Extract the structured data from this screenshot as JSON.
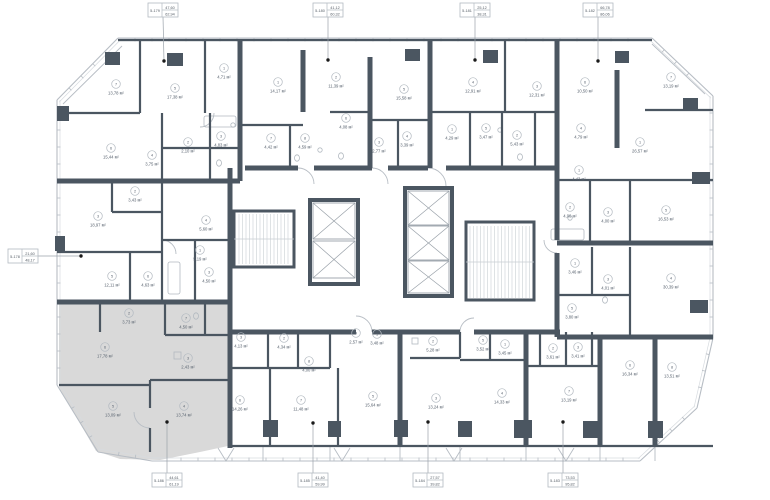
{
  "meta": {
    "area_unit": "м²",
    "selected_unit": "5-186",
    "colors": {
      "wall": "#4b5661",
      "highlight": "#d9d9d9",
      "line": "#b7bdc4",
      "text": "#5a6470",
      "dot": "#1a1a1a"
    }
  },
  "callouts": [
    {
      "id": "5-179",
      "v1": "47,60",
      "v2": "62,94",
      "bx": 148,
      "by": 3,
      "dx": 164,
      "dy": 61,
      "side": "top"
    },
    {
      "id": "5-180",
      "v1": "41,12",
      "v2": "60,32",
      "bx": 313,
      "by": 3,
      "dx": 328,
      "dy": 60,
      "side": "top"
    },
    {
      "id": "5-181",
      "v1": "25,12",
      "v2": "38,31",
      "bx": 460,
      "by": 3,
      "dx": 475,
      "dy": 60,
      "side": "top"
    },
    {
      "id": "5-182",
      "v1": "66,78",
      "v2": "86,06",
      "bx": 583,
      "by": 3,
      "dx": 598,
      "dy": 61,
      "side": "top"
    },
    {
      "id": "5-178",
      "v1": "21,60",
      "v2": "48,17",
      "bx": 8,
      "by": 249,
      "dx": 81,
      "dy": 256,
      "side": "left"
    },
    {
      "id": "5-186",
      "v1": "44,61",
      "v2": "61,19",
      "bx": 152,
      "by": 473,
      "dx": 167,
      "dy": 422,
      "side": "bottom"
    },
    {
      "id": "5-185",
      "v1": "41,40",
      "v2": "59,99",
      "bx": 298,
      "by": 473,
      "dx": 313,
      "dy": 423,
      "side": "bottom"
    },
    {
      "id": "5-184",
      "v1": "27,57",
      "v2": "39,82",
      "bx": 413,
      "by": 473,
      "dx": 428,
      "dy": 422,
      "side": "bottom"
    },
    {
      "id": "5-183",
      "v1": "73,53",
      "v2": "95,82",
      "bx": 548,
      "by": 473,
      "dx": 563,
      "dy": 422,
      "side": "bottom"
    }
  ],
  "rooms": [
    {
      "n": "7",
      "a": "13,78",
      "x": 116,
      "y": 84
    },
    {
      "n": "5",
      "a": "17,38",
      "x": 175,
      "y": 88
    },
    {
      "n": "1",
      "a": "4,71",
      "x": 224,
      "y": 68
    },
    {
      "n": "6",
      "a": "15,44",
      "x": 111,
      "y": 148
    },
    {
      "n": "2",
      "a": "2,10",
      "x": 188,
      "y": 142
    },
    {
      "n": "4",
      "a": "3,75",
      "x": 152,
      "y": 155
    },
    {
      "n": "3",
      "a": "4,83",
      "x": 221,
      "y": 136
    },
    {
      "n": "1",
      "a": "14,17",
      "x": 278,
      "y": 82
    },
    {
      "n": "2",
      "a": "11,39",
      "x": 336,
      "y": 77
    },
    {
      "n": "5",
      "a": "15,58",
      "x": 404,
      "y": 89
    },
    {
      "n": "6",
      "a": "4,08",
      "x": 346,
      "y": 118
    },
    {
      "n": "7",
      "a": "4,42",
      "x": 271,
      "y": 138
    },
    {
      "n": "8",
      "a": "4,59",
      "x": 305,
      "y": 138
    },
    {
      "n": "3",
      "a": "2,77",
      "x": 379,
      "y": 142
    },
    {
      "n": "4",
      "a": "3,39",
      "x": 407,
      "y": 136
    },
    {
      "n": "4",
      "a": "12,91",
      "x": 473,
      "y": 82
    },
    {
      "n": "3",
      "a": "12,31",
      "x": 537,
      "y": 86
    },
    {
      "n": "6",
      "a": "10,50",
      "x": 585,
      "y": 82
    },
    {
      "n": "1",
      "a": "4,29",
      "x": 452,
      "y": 129
    },
    {
      "n": "5",
      "a": "3,47",
      "x": 486,
      "y": 128
    },
    {
      "n": "2",
      "a": "5,43",
      "x": 517,
      "y": 135
    },
    {
      "n": "4",
      "a": "4,79",
      "x": 581,
      "y": 128
    },
    {
      "n": "7",
      "a": "13,19",
      "x": 671,
      "y": 77
    },
    {
      "n": "1",
      "a": "26,57",
      "x": 640,
      "y": 142
    },
    {
      "n": "1",
      "a": "4,43",
      "x": 579,
      "y": 170
    },
    {
      "n": "2",
      "a": "4,00",
      "x": 570,
      "y": 207
    },
    {
      "n": "3",
      "a": "4,00",
      "x": 608,
      "y": 212
    },
    {
      "n": "5",
      "a": "16,53",
      "x": 666,
      "y": 210
    },
    {
      "n": "1",
      "a": "3,46",
      "x": 575,
      "y": 263
    },
    {
      "n": "3",
      "a": "4,01",
      "x": 608,
      "y": 279
    },
    {
      "n": "4",
      "a": "30,39",
      "x": 671,
      "y": 278
    },
    {
      "n": "5",
      "a": "3,80",
      "x": 572,
      "y": 308
    },
    {
      "n": "2",
      "a": "3,43",
      "x": 135,
      "y": 191
    },
    {
      "n": "3",
      "a": "18,97",
      "x": 98,
      "y": 216
    },
    {
      "n": "4",
      "a": "5,60",
      "x": 206,
      "y": 220
    },
    {
      "n": "1",
      "a": "5,19",
      "x": 200,
      "y": 250
    },
    {
      "n": "5",
      "a": "12,11",
      "x": 112,
      "y": 276
    },
    {
      "n": "6",
      "a": "4,63",
      "x": 148,
      "y": 276
    },
    {
      "n": "3",
      "a": "4,50",
      "x": 209,
      "y": 272
    },
    {
      "n": "2",
      "a": "3,73",
      "x": 129,
      "y": 313
    },
    {
      "n": "7",
      "a": "4,50",
      "x": 186,
      "y": 318
    },
    {
      "n": "6",
      "a": "17,78",
      "x": 105,
      "y": 347
    },
    {
      "n": "3",
      "a": "2,43",
      "x": 188,
      "y": 358
    },
    {
      "n": "5",
      "a": "13,09",
      "x": 113,
      "y": 406
    },
    {
      "n": "4",
      "a": "13,74",
      "x": 184,
      "y": 406
    },
    {
      "n": "3",
      "a": "4,13",
      "x": 241,
      "y": 337
    },
    {
      "n": "2",
      "a": "4,34",
      "x": 284,
      "y": 338
    },
    {
      "n": "8",
      "a": "4,00",
      "x": 309,
      "y": 361
    },
    {
      "n": "4",
      "a": "2,57",
      "x": 356,
      "y": 333
    },
    {
      "n": "1",
      "a": "3,48",
      "x": 377,
      "y": 334
    },
    {
      "n": "6",
      "a": "14,26",
      "x": 240,
      "y": 400
    },
    {
      "n": "7",
      "a": "11,48",
      "x": 301,
      "y": 400
    },
    {
      "n": "5",
      "a": "15,64",
      "x": 373,
      "y": 396
    },
    {
      "n": "2",
      "a": "5,28",
      "x": 433,
      "y": 341
    },
    {
      "n": "3",
      "a": "13,24",
      "x": 436,
      "y": 398
    },
    {
      "n": "5",
      "a": "3,52",
      "x": 483,
      "y": 340
    },
    {
      "n": "1",
      "a": "3,45",
      "x": 505,
      "y": 344
    },
    {
      "n": "4",
      "a": "14,33",
      "x": 502,
      "y": 393
    },
    {
      "n": "2",
      "a": "3,61",
      "x": 553,
      "y": 348
    },
    {
      "n": "3",
      "a": "3,41",
      "x": 578,
      "y": 347
    },
    {
      "n": "7",
      "a": "13,19",
      "x": 569,
      "y": 391
    },
    {
      "n": "6",
      "a": "16,34",
      "x": 630,
      "y": 365
    },
    {
      "n": "8",
      "a": "13,51",
      "x": 672,
      "y": 367
    }
  ]
}
